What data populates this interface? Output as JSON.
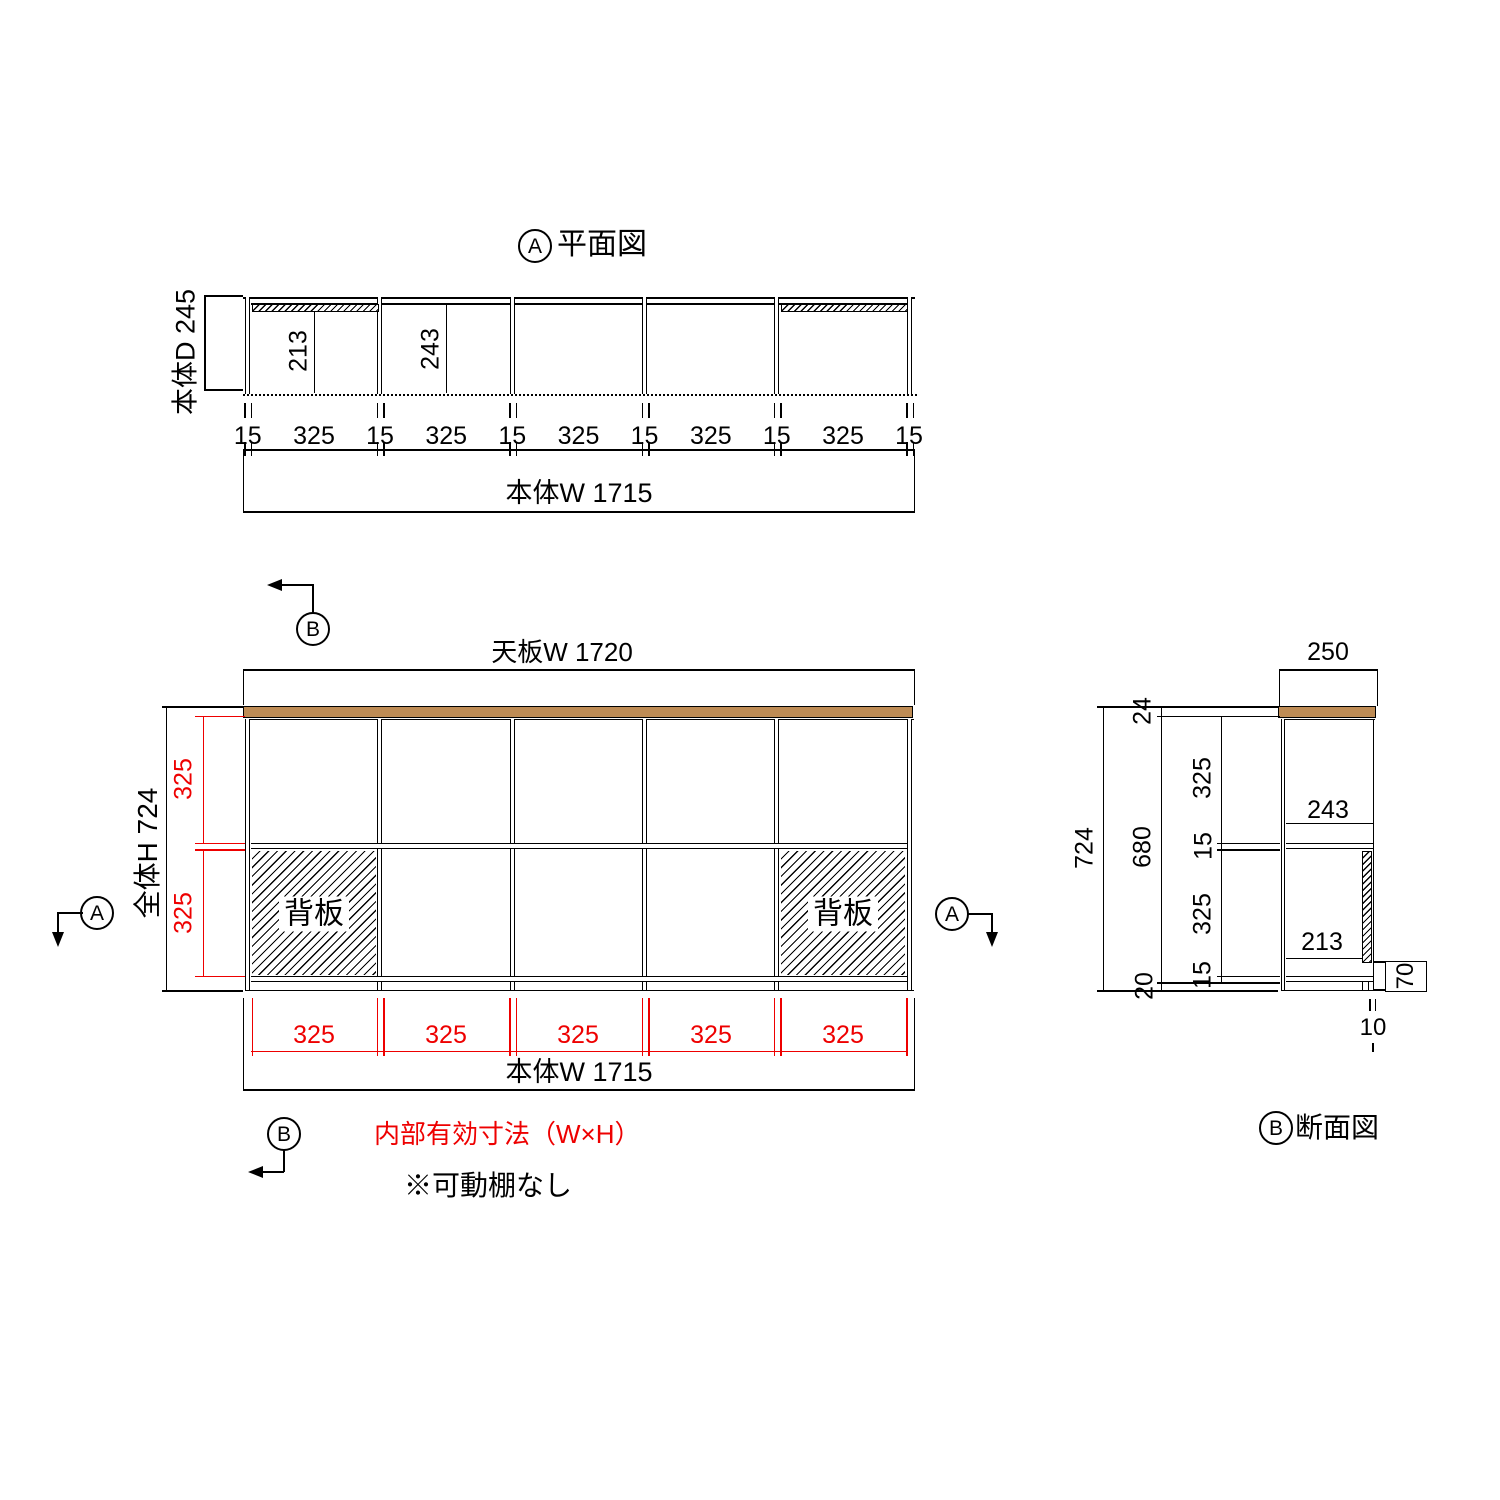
{
  "colors": {
    "red": "#ee0000",
    "brown": "#be8c55"
  },
  "plan": {
    "marker_letter": "A",
    "title": "平面図",
    "depth_label": "本体D 245",
    "dim_213": "213",
    "dim_243": "243",
    "bottom_dims": [
      "15",
      "325",
      "15",
      "325",
      "15",
      "325",
      "15",
      "325",
      "15",
      "325",
      "15"
    ],
    "width_label": "本体W 1715"
  },
  "front": {
    "section_marker_top": "B",
    "section_marker_bottom": "B",
    "section_marker_left": "A",
    "section_marker_right": "A",
    "top_width_label": "天板W 1720",
    "height_label": "全体H 724",
    "upper_row_dim": "325",
    "lower_row_dim": "325",
    "back_panel_left": "背板",
    "back_panel_right": "背板",
    "cell_dims": [
      "325",
      "325",
      "325",
      "325",
      "325"
    ],
    "width_label": "本体W 1715",
    "inner_note": "内部有効寸法（W×H）",
    "shelf_note": "※可動棚なし"
  },
  "section": {
    "marker_letter": "B",
    "title": "断面図",
    "depth_label": "250",
    "overall_height": "724",
    "top_thickness": "24",
    "inner_height": "680",
    "base_height": "20",
    "upper_inner_height": "325",
    "shelf_thickness": "15",
    "lower_inner_height": "325",
    "bottom_thickness": "15",
    "upper_depth": "243",
    "lower_depth": "213",
    "back_gap": "70",
    "back_thickness": "10"
  }
}
